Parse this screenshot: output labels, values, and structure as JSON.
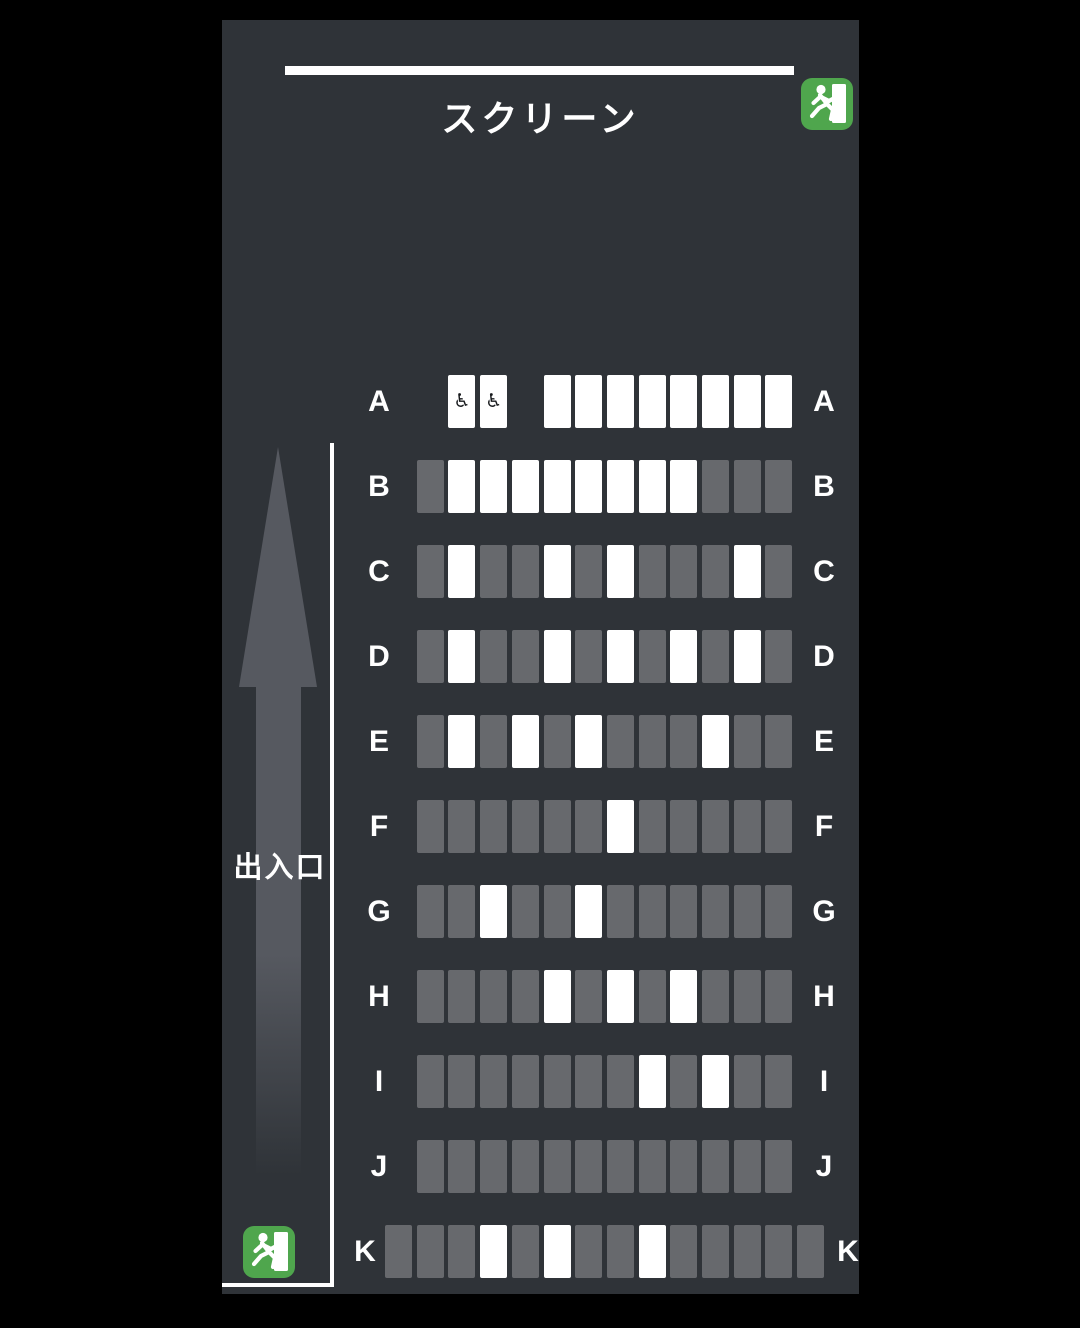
{
  "screen": {
    "label": "スクリーン"
  },
  "entrance": {
    "label": "出入口",
    "arrow_direction": "up"
  },
  "exits": {
    "top_right": "emergency-exit-sign",
    "bottom_left": "emergency-exit-sign"
  },
  "colors": {
    "background": "#000000",
    "panel": "#2f3338",
    "seat_available": "#ffffff",
    "seat_occupied": "#67696d",
    "exit_green": "#4fa64d",
    "arrow_gray": "#565960",
    "text": "#ffffff"
  },
  "seatmap": {
    "column_count": 14,
    "wheelchair_glyph": "♿",
    "rows": [
      {
        "label": "A",
        "seats": [
          "none",
          "none",
          "wheelchair",
          "wheelchair",
          "none",
          "available",
          "available",
          "available",
          "available",
          "available",
          "available",
          "available",
          "available",
          "none"
        ]
      },
      {
        "label": "B",
        "seats": [
          "none",
          "occupied",
          "available",
          "available",
          "available",
          "available",
          "available",
          "available",
          "available",
          "available",
          "occupied",
          "occupied",
          "occupied",
          "none"
        ]
      },
      {
        "label": "C",
        "seats": [
          "none",
          "occupied",
          "available",
          "occupied",
          "occupied",
          "available",
          "occupied",
          "available",
          "occupied",
          "occupied",
          "occupied",
          "available",
          "occupied",
          "none"
        ]
      },
      {
        "label": "D",
        "seats": [
          "none",
          "occupied",
          "available",
          "occupied",
          "occupied",
          "available",
          "occupied",
          "available",
          "occupied",
          "available",
          "occupied",
          "available",
          "occupied",
          "none"
        ]
      },
      {
        "label": "E",
        "seats": [
          "none",
          "occupied",
          "available",
          "occupied",
          "available",
          "occupied",
          "available",
          "occupied",
          "occupied",
          "occupied",
          "available",
          "occupied",
          "occupied",
          "none"
        ]
      },
      {
        "label": "F",
        "seats": [
          "none",
          "occupied",
          "occupied",
          "occupied",
          "occupied",
          "occupied",
          "occupied",
          "available",
          "occupied",
          "occupied",
          "occupied",
          "occupied",
          "occupied",
          "none"
        ]
      },
      {
        "label": "G",
        "seats": [
          "none",
          "occupied",
          "occupied",
          "available",
          "occupied",
          "occupied",
          "available",
          "occupied",
          "occupied",
          "occupied",
          "occupied",
          "occupied",
          "occupied",
          "none"
        ]
      },
      {
        "label": "H",
        "seats": [
          "none",
          "occupied",
          "occupied",
          "occupied",
          "occupied",
          "available",
          "occupied",
          "available",
          "occupied",
          "available",
          "occupied",
          "occupied",
          "occupied",
          "none"
        ]
      },
      {
        "label": "I",
        "seats": [
          "none",
          "occupied",
          "occupied",
          "occupied",
          "occupied",
          "occupied",
          "occupied",
          "occupied",
          "available",
          "occupied",
          "available",
          "occupied",
          "occupied",
          "none"
        ]
      },
      {
        "label": "J",
        "seats": [
          "none",
          "occupied",
          "occupied",
          "occupied",
          "occupied",
          "occupied",
          "occupied",
          "occupied",
          "occupied",
          "occupied",
          "occupied",
          "occupied",
          "occupied",
          "none"
        ]
      },
      {
        "label": "K",
        "seats": [
          "occupied",
          "occupied",
          "occupied",
          "available",
          "occupied",
          "available",
          "occupied",
          "occupied",
          "available",
          "occupied",
          "occupied",
          "occupied",
          "occupied",
          "occupied"
        ]
      }
    ]
  }
}
